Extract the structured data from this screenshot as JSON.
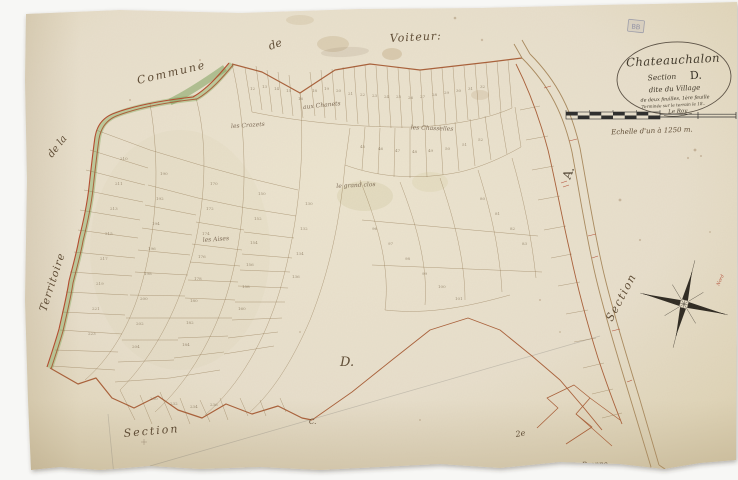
{
  "cartouche": {
    "title": "Chateauchalon",
    "section_word": "Section",
    "section_letter": "D.",
    "subtitle": "dite du Village",
    "sheet_note": "de deux feuilles, 1ère feuille",
    "survey_note": "Terminée sur le terrain le 18..",
    "signature": "Le Roy"
  },
  "scale_bar": {
    "caption": "Echelle d'un à 1250 m."
  },
  "stamp": {
    "text": "BB"
  },
  "compass": {
    "north_label": "Nord"
  },
  "margin_labels": {
    "commune": "Commune",
    "de": "de",
    "neighbor": "Voiteur:",
    "de_la": "de la",
    "territoire": "Territoire",
    "section_bottom": "Section",
    "section_right": "Section",
    "letter_a": "A.",
    "letter_d": "D.",
    "letter_c": "C.",
    "mark_2": "2e",
    "stream": "Brenne"
  },
  "place_labels": [
    {
      "text": "les Crozets",
      "x": 248,
      "y": 127,
      "r": -4
    },
    {
      "text": "aux Chanets",
      "x": 322,
      "y": 107,
      "r": -6
    },
    {
      "text": "les Chasselles",
      "x": 432,
      "y": 130,
      "r": 2
    },
    {
      "text": "le grand clos",
      "x": 356,
      "y": 187,
      "r": -3
    },
    {
      "text": "les Aises",
      "x": 216,
      "y": 241,
      "r": -4
    }
  ],
  "parcel_numbers": [
    {
      "n": 12,
      "x": 250,
      "y": 90
    },
    {
      "n": 13,
      "x": 262,
      "y": 88
    },
    {
      "n": 14,
      "x": 274,
      "y": 90
    },
    {
      "n": 15,
      "x": 286,
      "y": 92
    },
    {
      "n": 16,
      "x": 298,
      "y": 100
    },
    {
      "n": 18,
      "x": 312,
      "y": 92
    },
    {
      "n": 19,
      "x": 324,
      "y": 90
    },
    {
      "n": 20,
      "x": 336,
      "y": 92
    },
    {
      "n": 21,
      "x": 348,
      "y": 95
    },
    {
      "n": 22,
      "x": 360,
      "y": 96
    },
    {
      "n": 23,
      "x": 372,
      "y": 97
    },
    {
      "n": 24,
      "x": 384,
      "y": 98
    },
    {
      "n": 25,
      "x": 396,
      "y": 98
    },
    {
      "n": 26,
      "x": 408,
      "y": 99
    },
    {
      "n": 27,
      "x": 420,
      "y": 98
    },
    {
      "n": 28,
      "x": 432,
      "y": 96
    },
    {
      "n": 29,
      "x": 444,
      "y": 94
    },
    {
      "n": 30,
      "x": 456,
      "y": 92
    },
    {
      "n": 31,
      "x": 468,
      "y": 90
    },
    {
      "n": 32,
      "x": 480,
      "y": 88
    },
    {
      "n": 45,
      "x": 360,
      "y": 148
    },
    {
      "n": 46,
      "x": 378,
      "y": 150
    },
    {
      "n": 47,
      "x": 395,
      "y": 152
    },
    {
      "n": 48,
      "x": 412,
      "y": 153
    },
    {
      "n": 49,
      "x": 428,
      "y": 152
    },
    {
      "n": 50,
      "x": 445,
      "y": 150
    },
    {
      "n": 51,
      "x": 462,
      "y": 146
    },
    {
      "n": 52,
      "x": 478,
      "y": 141
    },
    {
      "n": 210,
      "x": 120,
      "y": 160
    },
    {
      "n": 211,
      "x": 115,
      "y": 185
    },
    {
      "n": 213,
      "x": 110,
      "y": 210
    },
    {
      "n": 215,
      "x": 105,
      "y": 235
    },
    {
      "n": 217,
      "x": 100,
      "y": 260
    },
    {
      "n": 219,
      "x": 96,
      "y": 285
    },
    {
      "n": 221,
      "x": 92,
      "y": 310
    },
    {
      "n": 223,
      "x": 88,
      "y": 335
    },
    {
      "n": 190,
      "x": 160,
      "y": 175
    },
    {
      "n": 192,
      "x": 156,
      "y": 200
    },
    {
      "n": 194,
      "x": 152,
      "y": 225
    },
    {
      "n": 196,
      "x": 148,
      "y": 250
    },
    {
      "n": 198,
      "x": 144,
      "y": 275
    },
    {
      "n": 200,
      "x": 140,
      "y": 300
    },
    {
      "n": 202,
      "x": 136,
      "y": 325
    },
    {
      "n": 204,
      "x": 132,
      "y": 348
    },
    {
      "n": 170,
      "x": 210,
      "y": 185
    },
    {
      "n": 172,
      "x": 206,
      "y": 210
    },
    {
      "n": 174,
      "x": 202,
      "y": 235
    },
    {
      "n": 176,
      "x": 198,
      "y": 258
    },
    {
      "n": 178,
      "x": 194,
      "y": 280
    },
    {
      "n": 180,
      "x": 190,
      "y": 302
    },
    {
      "n": 182,
      "x": 186,
      "y": 324
    },
    {
      "n": 184,
      "x": 182,
      "y": 346
    },
    {
      "n": 150,
      "x": 258,
      "y": 195
    },
    {
      "n": 152,
      "x": 254,
      "y": 220
    },
    {
      "n": 154,
      "x": 250,
      "y": 244
    },
    {
      "n": 156,
      "x": 246,
      "y": 266
    },
    {
      "n": 158,
      "x": 242,
      "y": 288
    },
    {
      "n": 160,
      "x": 238,
      "y": 310
    },
    {
      "n": 130,
      "x": 305,
      "y": 205
    },
    {
      "n": 132,
      "x": 300,
      "y": 230
    },
    {
      "n": 134,
      "x": 296,
      "y": 255
    },
    {
      "n": 136,
      "x": 292,
      "y": 278
    },
    {
      "n": 96,
      "x": 372,
      "y": 230
    },
    {
      "n": 97,
      "x": 388,
      "y": 245
    },
    {
      "n": 98,
      "x": 405,
      "y": 260
    },
    {
      "n": 99,
      "x": 422,
      "y": 275
    },
    {
      "n": 100,
      "x": 438,
      "y": 288
    },
    {
      "n": 101,
      "x": 455,
      "y": 300
    },
    {
      "n": 230,
      "x": 150,
      "y": 400
    },
    {
      "n": 232,
      "x": 170,
      "y": 405
    },
    {
      "n": 234,
      "x": 190,
      "y": 408
    },
    {
      "n": 236,
      "x": 210,
      "y": 406
    },
    {
      "n": 80,
      "x": 480,
      "y": 200
    },
    {
      "n": 81,
      "x": 495,
      "y": 215
    },
    {
      "n": 82,
      "x": 510,
      "y": 230
    },
    {
      "n": 83,
      "x": 522,
      "y": 245
    }
  ]
}
